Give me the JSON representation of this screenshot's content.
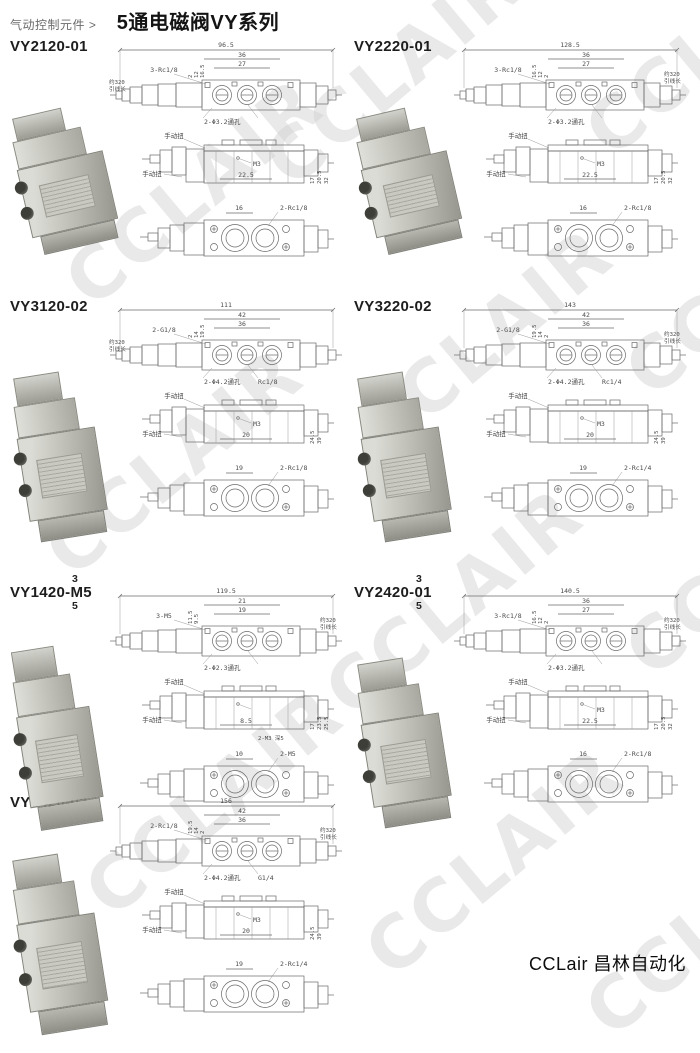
{
  "header": {
    "breadcrumb": "气动控制元件 >",
    "title": "5通电磁阀VY系列"
  },
  "watermark": {
    "text": "CCLAIR",
    "color": "#cfcfcf"
  },
  "footer": {
    "brand": "CCLair 昌林自动化"
  },
  "sections": [
    {
      "code": "VY2120-01",
      "top_view": {
        "overall": "96.5",
        "mid": "36",
        "inner": "27",
        "thread_label": "3-Rc1/8",
        "hole_label": "2-Φ3.2通孔",
        "lead_left_1": "约320",
        "lead_left_2": "引线长",
        "sd1": "2",
        "sd2": "12",
        "sd3": "16.5"
      },
      "front_view": {
        "manual_top": "手动扭",
        "manual_left": "手动扭",
        "thread": "M3",
        "dim": "22.5",
        "sd1": "17",
        "sd2": "20.5",
        "sd3": "32"
      },
      "bottom_view": {
        "dim": "16",
        "thread_label": "2-Rc1/8"
      }
    },
    {
      "code": "VY2220-01",
      "top_view": {
        "overall": "128.5",
        "mid": "36",
        "inner": "27",
        "thread_label": "3-Rc1/8",
        "hole_label": "2-Φ3.2通孔",
        "lead_right_1": "约320",
        "lead_right_2": "引线长",
        "sd1": "16.5",
        "sd2": "12",
        "sd3": "2"
      },
      "front_view": {
        "manual_top": "手动扭",
        "manual_left": "手动扭",
        "thread": "M3",
        "dim": "22.5",
        "sd1": "17",
        "sd2": "20.5",
        "sd3": "32"
      },
      "bottom_view": {
        "dim": "16",
        "thread_label": "2-Rc1/8"
      }
    },
    {
      "code": "VY3120-02",
      "top_view": {
        "overall": "111",
        "mid": "42",
        "inner": "36",
        "thread_label": "2-G1/8",
        "port_label": "Rc1/8",
        "hole_label": "2-Φ4.2通孔",
        "lead_left_1": "约320",
        "lead_left_2": "引线长",
        "sd1": "2",
        "sd2": "14",
        "sd3": "19.5"
      },
      "front_view": {
        "manual_top": "手动扭",
        "manual_left": "手动扭",
        "thread": "M3",
        "dim": "20",
        "sd1": "24.5",
        "sd2": "39"
      },
      "bottom_view": {
        "dim": "19",
        "thread_label": "2-Rc1/8"
      }
    },
    {
      "code": "VY3220-02",
      "top_view": {
        "overall": "143",
        "mid": "42",
        "inner": "36",
        "thread_label": "2-G1/8",
        "port_label": "Rc1/4",
        "hole_label": "2-Φ4.2通孔",
        "lead_right_1": "约320",
        "lead_right_2": "引线长",
        "sd1": "19.5",
        "sd2": "14",
        "sd3": "2"
      },
      "front_view": {
        "manual_top": "手动扭",
        "manual_left": "手动扭",
        "thread": "M3",
        "dim": "20",
        "sd1": "24.5",
        "sd2": "39"
      },
      "bottom_view": {
        "dim": "19",
        "thread_label": "2-Rc1/4"
      }
    },
    {
      "code": "VY1420-M5",
      "prefix_top": "3",
      "prefix_bottom": "5",
      "top_view": {
        "overall": "119.5",
        "mid": "21",
        "inner": "19",
        "thread_label": "3-M5",
        "hole_label": "2-Φ2.3通孔",
        "lead_right_1": "约320",
        "lead_right_2": "引线长",
        "sd1": "11.5",
        "sd2": "9.5"
      },
      "front_view": {
        "manual_top": "手动扭",
        "manual_left": "手动扭",
        "dim": "8.5",
        "extra_label": "2-M3 深5",
        "sd1": "17",
        "sd2": "23.5",
        "sd3": "25.5"
      },
      "bottom_view": {
        "dim": "10",
        "thread_label": "2-M5"
      }
    },
    {
      "code": "VY2420-01",
      "prefix_top": "3",
      "prefix_bottom": "5",
      "top_view": {
        "overall": "140.5",
        "mid": "36",
        "inner": "27",
        "thread_label": "3-Rc1/8",
        "hole_label": "2-Φ3.2通孔",
        "lead_right_1": "约320",
        "lead_right_2": "引线长",
        "sd1": "16.5",
        "sd2": "12",
        "sd3": "2"
      },
      "front_view": {
        "manual_top": "手动扭",
        "manual_left": "手动扭",
        "thread": "M3",
        "dim": "22.5",
        "sd1": "17",
        "sd2": "20.5",
        "sd3": "32"
      },
      "bottom_view": {
        "dim": "16",
        "thread_label": "2-Rc1/8"
      }
    },
    {
      "code": "VY3420-02",
      "prefix_top": "3",
      "prefix_bottom": "5",
      "top_view": {
        "overall": "156",
        "mid": "42",
        "inner": "36",
        "thread_label": "2-Rc1/8",
        "port_label": "G1/4",
        "hole_label": "2-Φ4.2通孔",
        "lead_right_1": "约320",
        "lead_right_2": "引线长",
        "sd1": "19.5",
        "sd2": "14",
        "sd3": "2"
      },
      "front_view": {
        "manual_top": "手动扭",
        "manual_left": "手动扭",
        "thread": "M3",
        "dim": "20",
        "sd1": "24.5",
        "sd2": "39"
      },
      "bottom_view": {
        "dim": "19",
        "thread_label": "2-Rc1/4"
      }
    }
  ]
}
